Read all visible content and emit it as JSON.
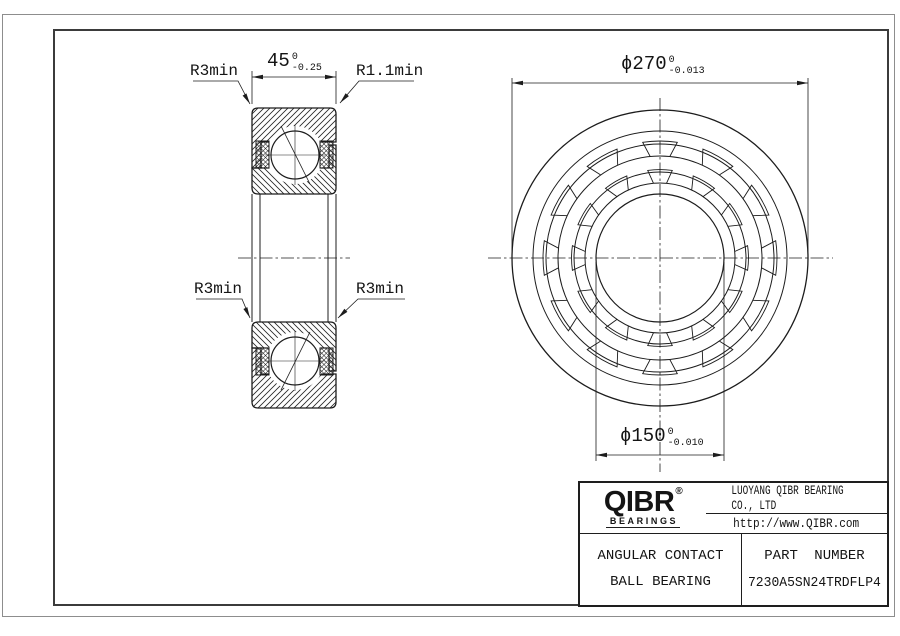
{
  "drawing": {
    "labels": {
      "r_top_left": "R3min",
      "r_top_right": "R1.1min",
      "r_bottom_left": "R3min",
      "r_bottom_right": "R3min"
    },
    "dims": {
      "width": {
        "text": "45",
        "tol_up": "0",
        "tol_dn": "-0.25"
      },
      "od": {
        "text": "ϕ270",
        "tol_up": "0",
        "tol_dn": "-0.013"
      },
      "bore": {
        "text": "ϕ150",
        "tol_up": "0",
        "tol_dn": "-0.010"
      }
    }
  },
  "title_block": {
    "brand": "QIBR",
    "brand_mark": "®",
    "brand_sub": "BEARINGS",
    "company": "LUOYANG QIBR BEARING CO., LTD",
    "website": "http://www.QIBR.com",
    "product": {
      "line1": "ANGULAR CONTACT",
      "line2": "BALL BEARING"
    },
    "part_number_label": "PART NUMBER",
    "part_number": "7230A5SN24TRDFLP4"
  },
  "colors": {
    "line": "#1c1c1c",
    "frame": "#3b3b3b",
    "sheet_border": "#8d8d8d",
    "background": "#ffffff"
  }
}
